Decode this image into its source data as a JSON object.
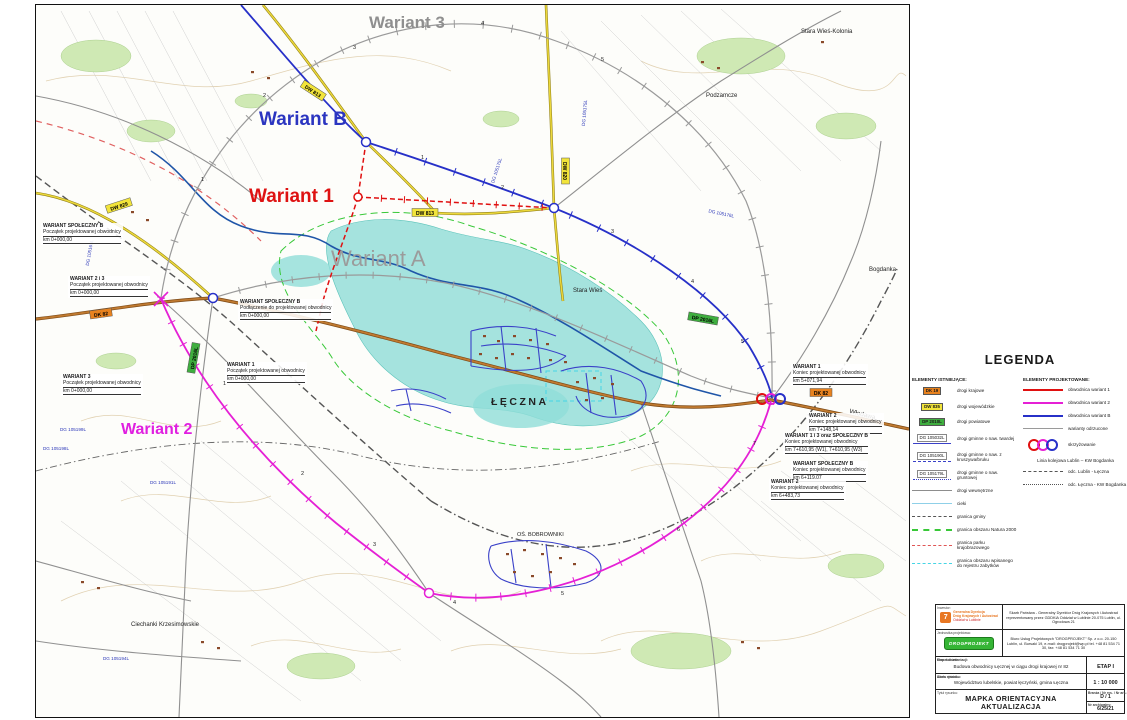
{
  "map": {
    "variant_labels": [
      "Wariant 3",
      "Wariant B",
      "Wariant 1",
      "Wariant A",
      "Wariant 2"
    ],
    "place_labels": [
      "Stara Wieś-Kolonia",
      "Podzamcze",
      "Stara Wieś",
      "ŁĘCZNA",
      "OŚ. BOBROWNIKI",
      "Bogdanka",
      "Włodawa",
      "Ciechanki Krzesimowskie"
    ],
    "road_badges": [
      "DW 829",
      "DW 813",
      "DW 813",
      "DW 820",
      "DK 82",
      "DK 82",
      "DP 2016L",
      "DP 2016L"
    ],
    "dg_labels": [
      "DG 105166L",
      "DG 105175L",
      "DG 105175L",
      "DG 105176L",
      "DG 105199L",
      "DG 105198L",
      "DG 105191L",
      "DG 105194L"
    ],
    "km_marks": [
      "1",
      "2",
      "3",
      "4",
      "5",
      "6",
      "7"
    ],
    "callouts": [
      {
        "title": "WARIANT SPOŁECZNY B",
        "line2": "Początek projektowanej obwodnicy",
        "line3": "km 0+000,00"
      },
      {
        "title": "WARIANT 2 i 3",
        "line2": "Początek projektowanej obwodnicy",
        "line3": "km 0+000,00"
      },
      {
        "title": "WARIANT SPOŁECZNY B",
        "line2": "Podłączenie do projektowanej obwodnicy",
        "line3": "km 0+000,00"
      },
      {
        "title": "WARIANT 3",
        "line2": "Początek projektowanej obwodnicy",
        "line3": "km 0+000,00"
      },
      {
        "title": "WARIANT 1",
        "line2": "Początek projektowanej obwodnicy",
        "line3": "km 0+000,00"
      },
      {
        "title": "WARIANT 1",
        "line2": "Koniec projektowanej obwodnicy",
        "line3": "km 5+071,94"
      },
      {
        "title": "WARIANT 2",
        "line2": "Koniec projektowanej obwodnicy",
        "line3": "km 7+148,14"
      },
      {
        "title": "WARIANT 1 i 3 oraz SPOŁECZNY B",
        "line2": "Koniec projektowanej obwodnicy",
        "line3": "km 7+610,95 (W1), 7+610,95 (W3)"
      },
      {
        "title": "WARIANT SPOŁECZNY B",
        "line2": "Koniec projektowanej obwodnicy",
        "line3": "km 6+119,07"
      },
      {
        "title": "WARIANT 2",
        "line2": "Koniec projektowanej obwodnicy",
        "line3": "km 6+483,73"
      }
    ]
  },
  "legend": {
    "title": "LEGENDA",
    "existing": {
      "title": "ELEMENTY ISTNIEJĄCE:",
      "items": [
        {
          "badge": "DK 19",
          "label": "drogi krajowe"
        },
        {
          "badge": "DW 835",
          "label": "drogi wojewódzkie"
        },
        {
          "badge": "DP 2010L",
          "label": "drogi powiatowe"
        },
        {
          "badge": "DG 105032L",
          "label": "drogi gminne o naw. twardej"
        },
        {
          "badge": "DG 105190L",
          "label": "drogi gminne o naw. z kruszywa/bruku"
        },
        {
          "badge": "DG 105179L",
          "label": "drogi gminne o naw. gruntowej"
        },
        {
          "label": "drogi wewnętrzne"
        },
        {
          "label": "cieki"
        },
        {
          "label": "granica gminy"
        },
        {
          "label": "granica obszaru Natura 2000"
        },
        {
          "label": "granica parku krajobrazowego"
        },
        {
          "label": "granica obszaru wpisanego do rejestru zabytków"
        }
      ]
    },
    "projected": {
      "title": "ELEMENTY PROJEKTOWANE:",
      "items": [
        {
          "label": "obwodnica wariant 1"
        },
        {
          "label": "obwodnica wariant 2"
        },
        {
          "label": "obwodnica wariant B"
        },
        {
          "label": "warianty odrzucone"
        },
        {
          "label": "skrzyżowanie"
        },
        {
          "label": "Linia kolejowa Lublin – KW Bogdanka"
        },
        {
          "label": "odc. Lublin - Łęczna"
        },
        {
          "label": "odc. Łęczna - KW Bogdanka"
        }
      ]
    }
  },
  "title_block": {
    "investor_label": "Inwestor:",
    "investor_logo_line1": "Generalna Dyrekcja",
    "investor_logo_line2": "Dróg Krajowych i Autostrad",
    "investor_logo_line3": "Oddział w Lublinie",
    "investor_text": "Skarb Państwa - Generalny Dyrektor Dróg Krajowych i Autostrad reprezentowany przez GDDKiA Oddział w Lublinie 20-075 Lublin, ul. Ogrodowa 21",
    "designer_label": "Jednostka projektowa:",
    "designer_logo": "DROGPROJEKT",
    "designer_text": "Biuro Usług Projektowych \"DROGPROJEKT\" Sp. z o.o. 20-150 Lublin, ul. Bursaki 19, e-mail: drogprojekt@wp.pl tel. +48 81 534 71 30,  fax: +48 81 534 71 30",
    "object_label": "Nazwa obiektu:",
    "object_name": "Budowa obwodnicy Łęcznej w ciągu drogi krajowej nr 82",
    "stage_label": "Etap dokumentacji:",
    "stage_value": "ETAP I",
    "address_label": "Adres obiektu:",
    "address_value": "Województwo lubelskie, powiat łęczyński, gmina Łęczna",
    "scale_label": "Skala rysunku:",
    "scale_value": "1 : 10 000",
    "drawing_label": "Tytuł rysunku:",
    "drawing_title_line1": "MAPKA ORIENTACYJNA",
    "drawing_title_line2": "AKTUALIZACJA",
    "branch_label": "Branża / Nr rys. / Nr ark.:",
    "branch_value": "D / 1",
    "archive_label": "Nr archiwalny:",
    "archive_value": "6/25/21"
  },
  "colors": {
    "wariant1": "#e01010",
    "wariant2": "#e520d5",
    "wariantB": "#2730c8",
    "rejected": "#9a9a9a",
    "dk_badge": "#e8821e",
    "dw_badge": "#f2e43a",
    "dp_badge": "#3fae3f",
    "natura2000": "#38c838",
    "park": "#e05555",
    "zabytki": "#45d5e5",
    "cieki": "#8fd0e8"
  }
}
